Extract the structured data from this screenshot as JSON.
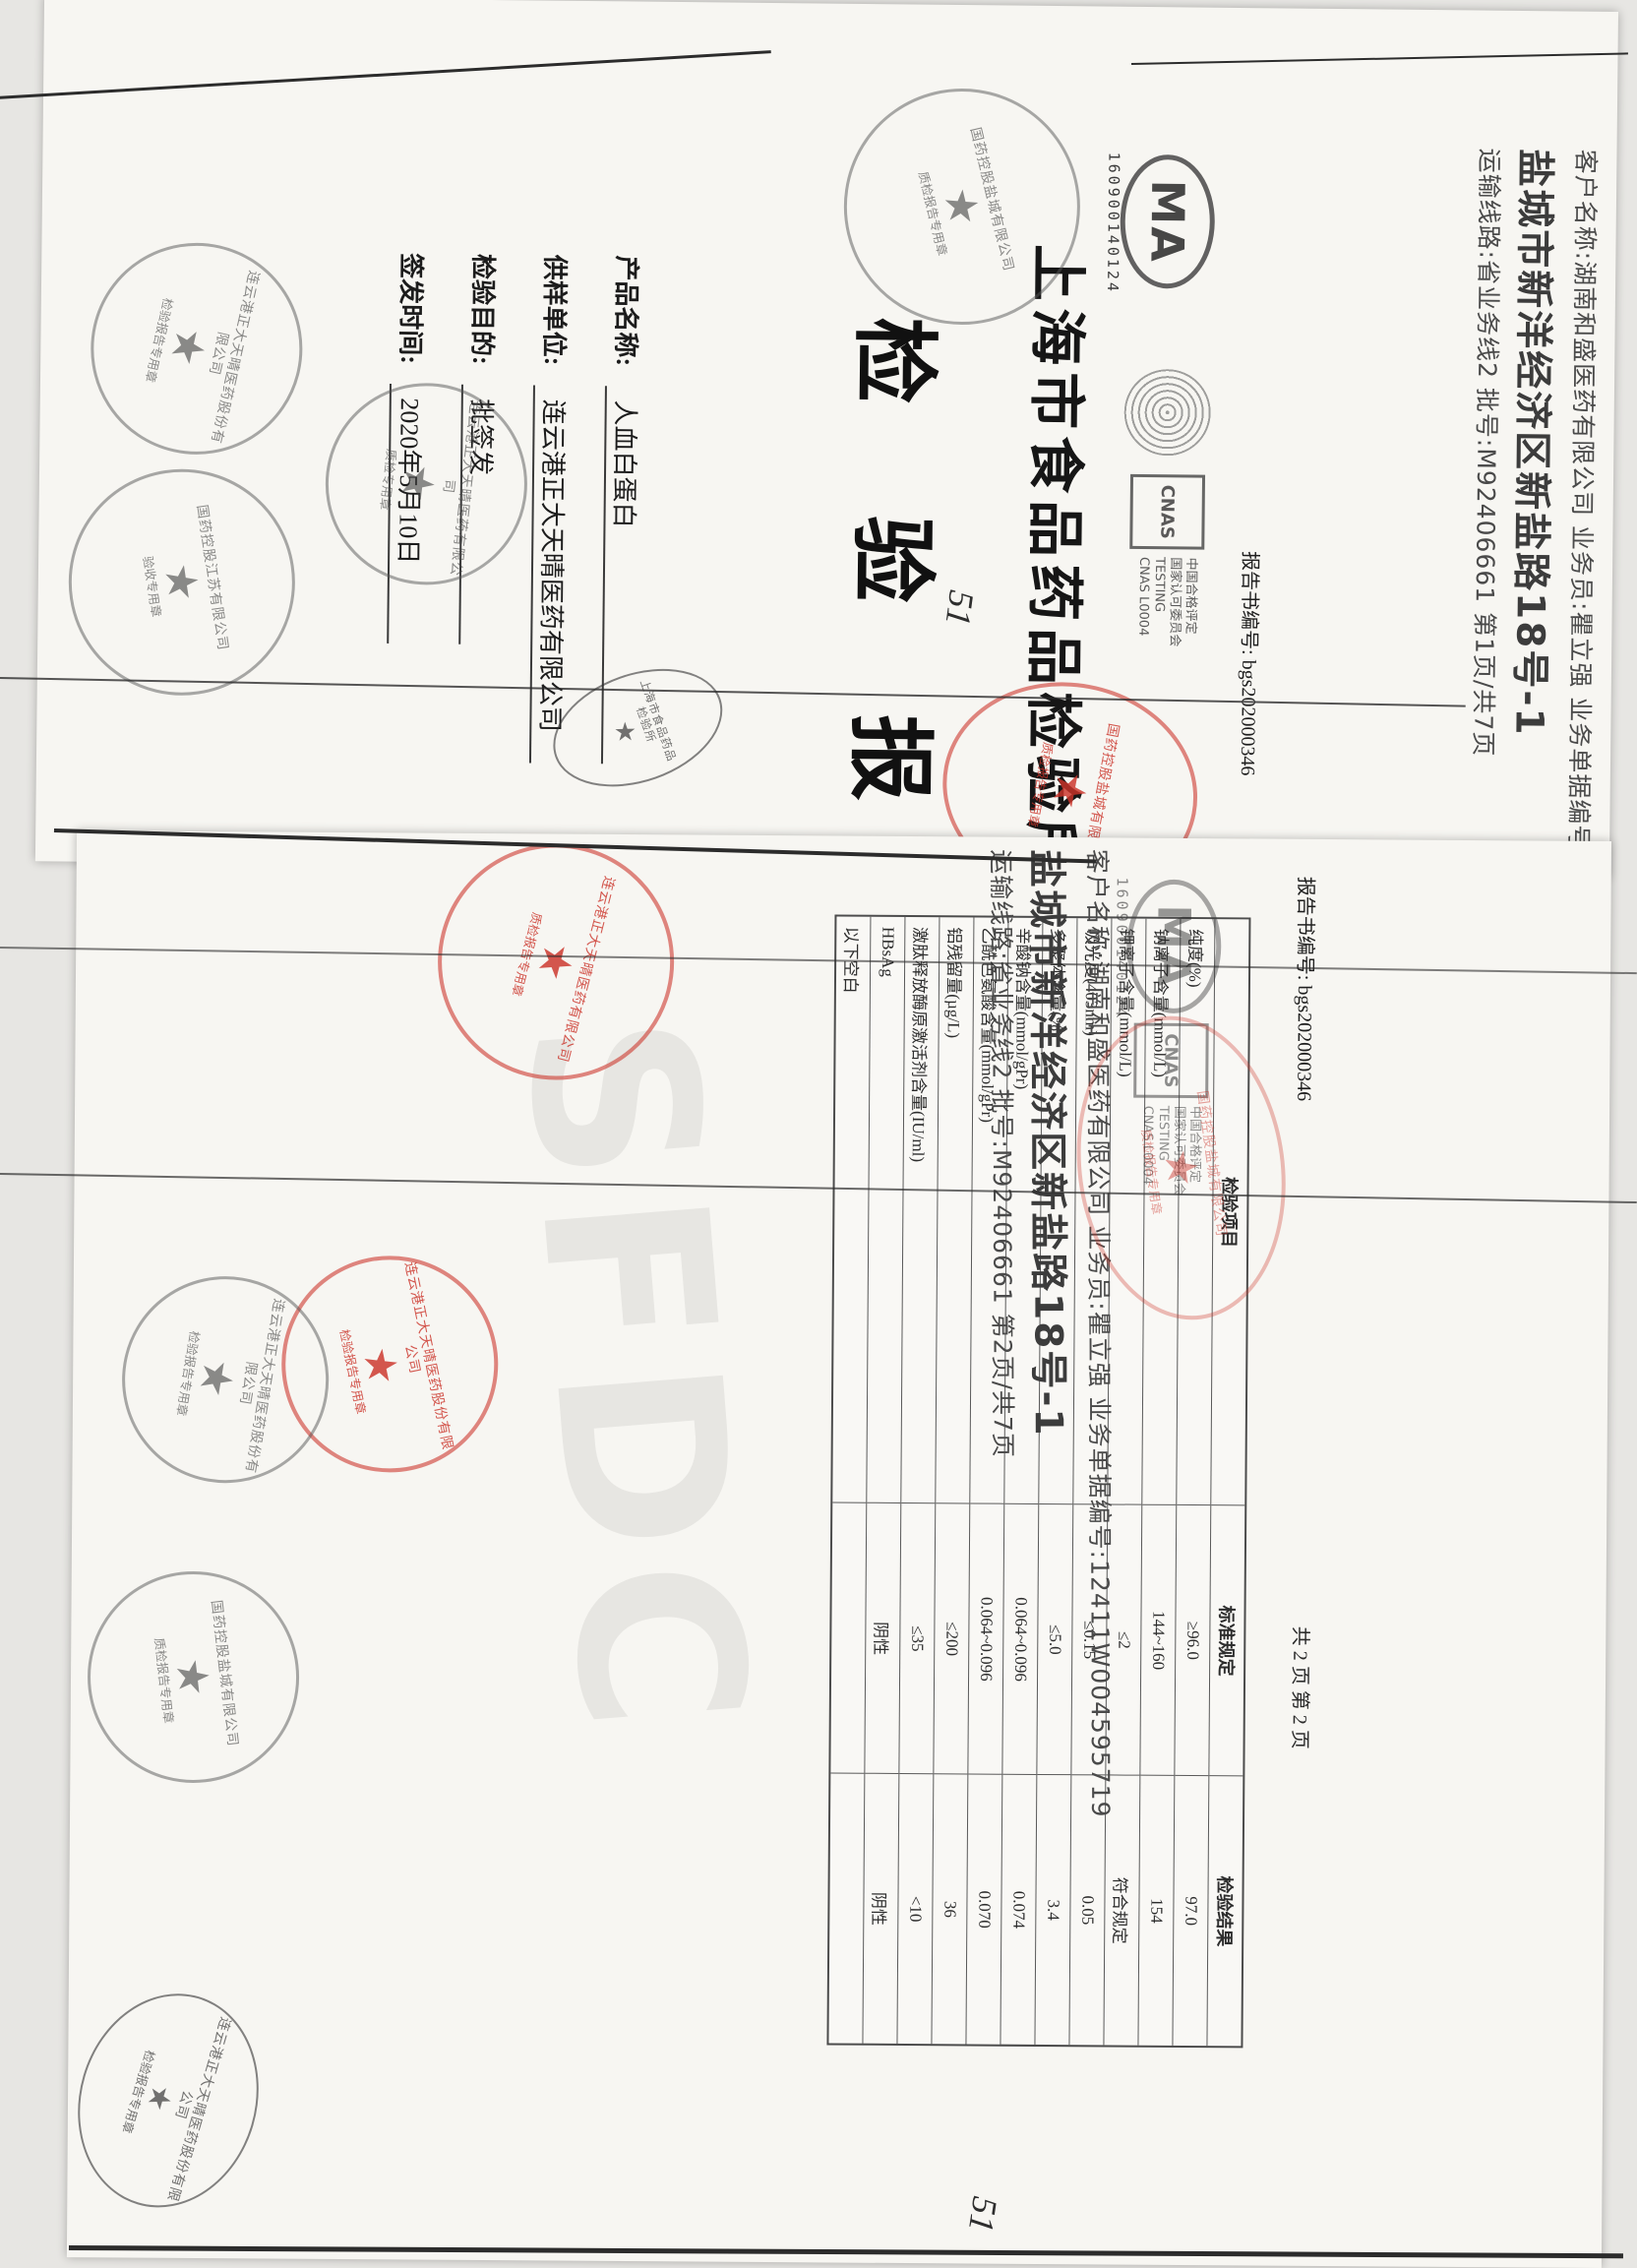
{
  "page1": {
    "shipping": {
      "line1": "客户名称:湖南和盛医药有限公司  业务员:瞿立强  业务单据编号:12411W004595719",
      "address": "盐城市新洋经济区新盐路18号-1",
      "line2": "运输线路:省业务线2  批号:M92406661  第1页/共7页"
    },
    "cma": {
      "mark": "MA",
      "barcode": "160900140124"
    },
    "cnas": {
      "mark": "CNAS",
      "line1": "中国合格评定",
      "line2": "国家认可委员会",
      "line3": "TESTING",
      "line4": "CNAS L0004"
    },
    "report_no_label": "报告书编号:",
    "report_no": "bgs202000346",
    "org": "上海市食品药品检验所",
    "title": "检 验 报 告",
    "fields": [
      {
        "label": "产品名称:",
        "value": "人血白蛋白"
      },
      {
        "label": "供样单位:",
        "value": "连云港正大天晴医药有限公司"
      },
      {
        "label": "检验目的:",
        "value": "批签发"
      },
      {
        "label": "签发时间:",
        "value": "2020年5月10日"
      }
    ],
    "note": "51",
    "stamps": {
      "gray_round_1": {
        "ring": "国药控股盐城有限公司",
        "center": "★",
        "bottom": "质检报告专用章"
      },
      "red_oval": {
        "ring": "国药控股盐城有限公司",
        "center": "★",
        "bottom": "质检报告专用章"
      },
      "black_oval": {
        "ring": "上海市食品药品检验所",
        "center": "★",
        "bottom": ""
      },
      "gray_round_2": {
        "ring": "连云港正大天晴医药股份有限公司",
        "center": "★",
        "bottom": "检验报告专用章"
      },
      "gray_round_3": {
        "ring": "国药控股江苏有限公司",
        "center": "★",
        "bottom": "验收专用章"
      },
      "gray_round_4": {
        "ring": "连云港正大天晴医药有限公司",
        "center": "★",
        "bottom": "质检专用章"
      }
    }
  },
  "page2": {
    "shipping": {
      "line1": "客户名称:湖南和盛医药有限公司  业务员:瞿立强  业务单据编号:12411W004595719",
      "address": "盐城市新洋经济区新盐路18号-1",
      "line2": "运输线路:省业务线2  批号:M92406661  第2页/共7页"
    },
    "report_no_line": "报告书编号: bgs202000346",
    "pages_line": "共 2 页  第 2 页",
    "watermark": "SFDC",
    "note": "51",
    "table": {
      "headers": [
        "检验项目",
        "标准规定",
        "检验结果"
      ],
      "rows": [
        {
          "item": "纯度(%)",
          "std": "≥96.0",
          "result": "97.0"
        },
        {
          "item": "钠离子含量(mmol/L)",
          "std": "144~160",
          "result": "154"
        },
        {
          "item": "钾离子含量(mmol/L)",
          "std": "≤2",
          "result": "符合规定"
        },
        {
          "item": "吸光度(403nm)",
          "std": "≤0.15",
          "result": "0.05"
        },
        {
          "item": "多聚体含量(%)",
          "std": "≤5.0",
          "result": "3.4"
        },
        {
          "item": "辛酸钠含量(mmol/gPr)",
          "std": "0.064~0.096",
          "result": "0.074"
        },
        {
          "item": "乙酰色氨酸含量(mmol/gPr)",
          "std": "0.064~0.096",
          "result": "0.070"
        },
        {
          "item": "铝残留量(µg/L)",
          "std": "≤200",
          "result": "36"
        },
        {
          "item": "激肽释放酶原激活剂含量(IU/ml)",
          "std": "≤35",
          "result": "<10"
        },
        {
          "item": "HBsAg",
          "std": "阴性",
          "result": "阴性"
        },
        {
          "item": "以下空白",
          "std": "",
          "result": ""
        }
      ]
    },
    "cma": {
      "mark": "MA",
      "barcode": "160900140124"
    },
    "cnas": {
      "mark": "CNAS",
      "line1": "中国合格评定",
      "line2": "国家认可委员会",
      "line3": "TESTING",
      "line4": "CNAS L0004"
    },
    "stamps": {
      "red_oval": {
        "ring": "国药控股盐城有限公司",
        "center": "★",
        "bottom": "质检报告专用章"
      },
      "red_round_1": {
        "ring": "连云港正大天晴医药有限公司",
        "center": "★",
        "bottom": "质检报告专用章"
      },
      "red_round_2": {
        "ring": "连云港正大天晴医药股份有限公司",
        "center": "★",
        "bottom": "检验报告专用章"
      },
      "gray_round_1": {
        "ring": "连云港正大天晴医药股份有限公司",
        "center": "★",
        "bottom": "检验报告专用章"
      },
      "gray_round_2": {
        "ring": "国药控股盐城有限公司",
        "center": "★",
        "bottom": "质检报告专用章"
      },
      "gray_round_3": {
        "ring": "连云港正大天晴医药股份有限公司",
        "center": "★",
        "bottom": "检验报告专用章"
      }
    }
  }
}
